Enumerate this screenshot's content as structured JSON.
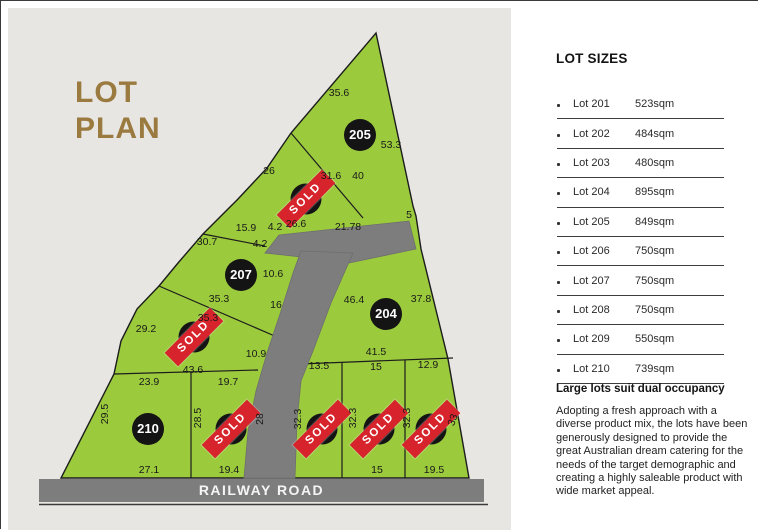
{
  "title": {
    "line1": "LOT",
    "line2": "PLAN"
  },
  "colors": {
    "lot_green": "#9bca3d",
    "road_gray": "#7d7d7d",
    "sold_red": "#d7232b",
    "title_gold": "#9a7a3f",
    "panel_gray": "#e7e6e3"
  },
  "road": {
    "label": "RAILWAY ROAD"
  },
  "map": {
    "sold_label": "SOLD",
    "lots_on_map": [
      {
        "number": "205",
        "x": 359,
        "y": 134,
        "sold": false
      },
      {
        "number": "206",
        "x": 305,
        "y": 198,
        "sold": true
      },
      {
        "number": "207",
        "x": 240,
        "y": 274,
        "sold": false
      },
      {
        "number": "208",
        "x": 193,
        "y": 336,
        "sold": true
      },
      {
        "number": "204",
        "x": 385,
        "y": 313,
        "sold": false
      },
      {
        "number": "210",
        "x": 147,
        "y": 428,
        "sold": false
      },
      {
        "number": "209",
        "x": 230,
        "y": 428,
        "sold": true
      },
      {
        "number": "203",
        "x": 321,
        "y": 428,
        "sold": true
      },
      {
        "number": "202",
        "x": 378,
        "y": 428,
        "sold": true
      },
      {
        "number": "201",
        "x": 430,
        "y": 428,
        "sold": true
      }
    ],
    "measurements": [
      {
        "t": "35.6",
        "x": 338,
        "y": 92,
        "r": 0
      },
      {
        "t": "53.3",
        "x": 390,
        "y": 144,
        "r": 0
      },
      {
        "t": "26",
        "x": 268,
        "y": 170,
        "r": 0
      },
      {
        "t": "31.6",
        "x": 330,
        "y": 175,
        "r": 0
      },
      {
        "t": "40",
        "x": 357,
        "y": 175,
        "r": 0
      },
      {
        "t": "15.9",
        "x": 245,
        "y": 227,
        "r": 0
      },
      {
        "t": "4.2",
        "x": 274,
        "y": 226,
        "r": 0
      },
      {
        "t": "26.6",
        "x": 295,
        "y": 223,
        "r": 0
      },
      {
        "t": "21.78",
        "x": 347,
        "y": 226,
        "r": 0
      },
      {
        "t": "5",
        "x": 408,
        "y": 214,
        "r": 0
      },
      {
        "t": "30.7",
        "x": 206,
        "y": 241,
        "r": 0
      },
      {
        "t": "4.2",
        "x": 259,
        "y": 243,
        "r": 0
      },
      {
        "t": "10.6",
        "x": 272,
        "y": 273,
        "r": 0
      },
      {
        "t": "35.3",
        "x": 218,
        "y": 298,
        "r": 0
      },
      {
        "t": "16",
        "x": 275,
        "y": 304,
        "r": 0
      },
      {
        "t": "46.4",
        "x": 353,
        "y": 299,
        "r": 0
      },
      {
        "t": "37.8",
        "x": 420,
        "y": 298,
        "r": 0
      },
      {
        "t": "35.3",
        "x": 207,
        "y": 317,
        "r": 0
      },
      {
        "t": "29.2",
        "x": 145,
        "y": 328,
        "r": 0
      },
      {
        "t": "41.5",
        "x": 375,
        "y": 351,
        "r": 0
      },
      {
        "t": "10.9",
        "x": 255,
        "y": 353,
        "r": 0
      },
      {
        "t": "43.6",
        "x": 192,
        "y": 369,
        "r": 0
      },
      {
        "t": "23.9",
        "x": 148,
        "y": 381,
        "r": 0
      },
      {
        "t": "19.7",
        "x": 227,
        "y": 381,
        "r": 0
      },
      {
        "t": "13.5",
        "x": 318,
        "y": 365,
        "r": 0
      },
      {
        "t": "15",
        "x": 375,
        "y": 366,
        "r": 0
      },
      {
        "t": "12.9",
        "x": 427,
        "y": 364,
        "r": 0
      },
      {
        "t": "29.5",
        "x": 104,
        "y": 413,
        "r": -90
      },
      {
        "t": "28.5",
        "x": 197,
        "y": 417,
        "r": -90
      },
      {
        "t": "28",
        "x": 259,
        "y": 418,
        "r": -90
      },
      {
        "t": "32.3",
        "x": 297,
        "y": 418,
        "r": -90
      },
      {
        "t": "32.3",
        "x": 352,
        "y": 417,
        "r": -90
      },
      {
        "t": "32.3",
        "x": 406,
        "y": 417,
        "r": -90
      },
      {
        "t": "33",
        "x": 452,
        "y": 419,
        "r": -70
      },
      {
        "t": "27.1",
        "x": 148,
        "y": 469,
        "r": 0
      },
      {
        "t": "19.4",
        "x": 228,
        "y": 469,
        "r": 0
      },
      {
        "t": "15",
        "x": 376,
        "y": 469,
        "r": 0
      },
      {
        "t": "19.5",
        "x": 433,
        "y": 469,
        "r": 0
      }
    ]
  },
  "sidebar": {
    "heading": "LOT SIZES",
    "lots": [
      {
        "name": "Lot 201",
        "size": "523sqm"
      },
      {
        "name": "Lot 202",
        "size": "484sqm"
      },
      {
        "name": "Lot 203",
        "size": "480sqm"
      },
      {
        "name": "Lot 204",
        "size": "895sqm"
      },
      {
        "name": "Lot 205",
        "size": "849sqm"
      },
      {
        "name": "Lot 206",
        "size": "750sqm"
      },
      {
        "name": "Lot 207",
        "size": "750sqm"
      },
      {
        "name": "Lot 208",
        "size": "750sqm"
      },
      {
        "name": "Lot 209",
        "size": "550sqm"
      },
      {
        "name": "Lot 210",
        "size": "739sqm"
      }
    ],
    "subheading": "Large lots suit dual occupancy",
    "paragraph": "Adopting a fresh approach with a diverse product mix, the lots have been generously designed to provide the great Australian dream catering for the needs of the target demographic and creating a highly saleable product with wide market appeal."
  }
}
